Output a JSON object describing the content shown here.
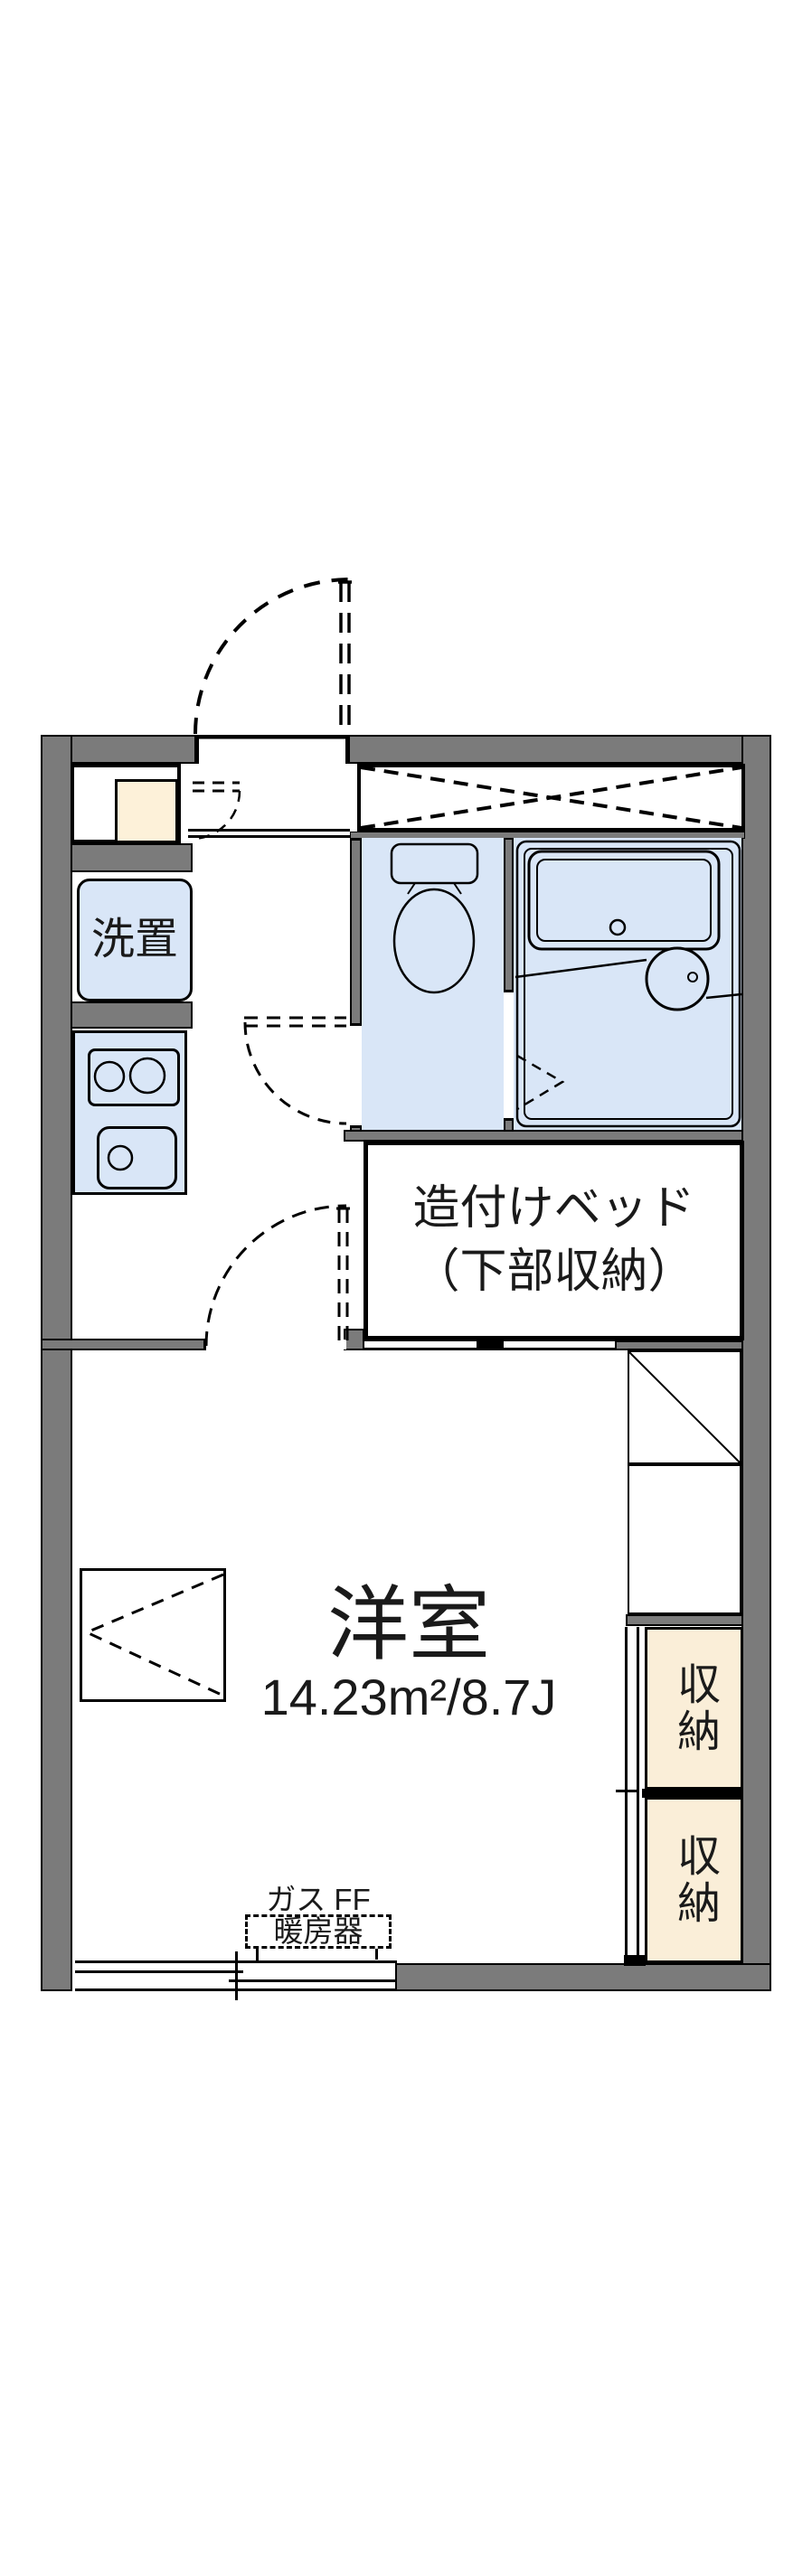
{
  "document": {
    "kind": "apartment-floor-plan",
    "orientation": "portrait"
  },
  "colors": {
    "wall_gray": "#7b7b7b",
    "fixture_blue": "#d9e6f7",
    "storage_cream": "#faeed8",
    "water_heater_cream": "#fdf1d9",
    "line_black": "#000000",
    "background": "#ffffff"
  },
  "rooms": {
    "western_room": {
      "name": "洋室",
      "area": "14.23m²/8.7J"
    },
    "built_in_bed": {
      "line1": "造付けベッド",
      "line2": "（下部収納）"
    },
    "washer_place": {
      "label": "洗置"
    },
    "storage_upper": {
      "label": "収納"
    },
    "storage_lower": {
      "label": "収納"
    },
    "gas_heater": {
      "line1": "ガス FF",
      "line2": "暖房器"
    }
  },
  "fixtures": {
    "toilet": "toilet",
    "bathtub": "bathtub",
    "washbasin": "washbasin",
    "stove_burners": "2-burner-stove",
    "kitchen_sink": "kitchen-sink",
    "entrance_closet": "closet-with-dashed-x",
    "fold_table": "fold-down-table",
    "balcony_window": "sliding-window"
  }
}
